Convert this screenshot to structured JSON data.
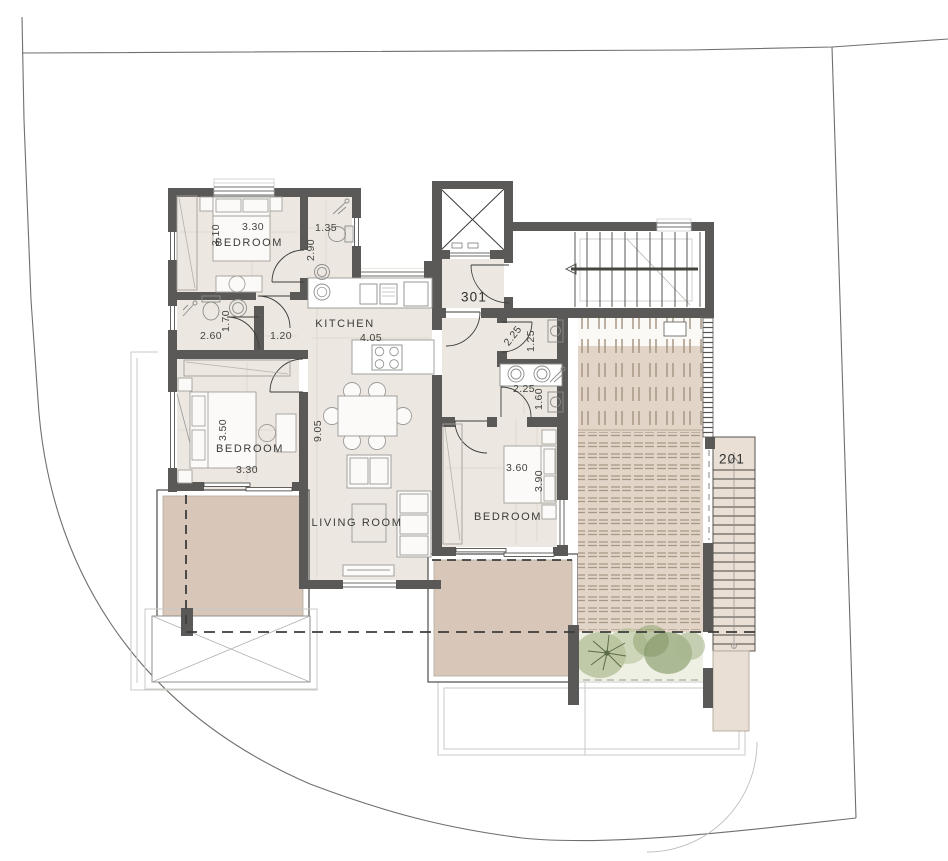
{
  "title": "apartment floor plan",
  "rooms": {
    "bedroom_top": {
      "label": "BEDROOM",
      "width": "3.30",
      "depth": "3.10"
    },
    "bathroom_top": {
      "width": "1.35",
      "depth": "2.90"
    },
    "wc": {
      "width": "2.60",
      "depth": "1.70"
    },
    "hallway": {
      "width": "1.20"
    },
    "kitchen": {
      "label": "KITCHEN",
      "width": "4.05"
    },
    "entrance_hall": {
      "label": "301"
    },
    "utility": {
      "width": "2.25",
      "depth": "1.25"
    },
    "bathroom_right": {
      "width": "2.25",
      "depth": "1.60"
    },
    "bedroom_left": {
      "label": "BEDROOM",
      "width": "3.30",
      "depth": "3.50"
    },
    "living_room": {
      "label": "LIVING ROOM",
      "depth": "9.05"
    },
    "bedroom_right": {
      "label": "BEDROOM",
      "width": "3.60",
      "depth": "3.90"
    },
    "external_stair": {
      "label": "201"
    }
  },
  "colors": {
    "wall": "#5a5958",
    "floor": "#ece7e0",
    "balcony": "#d8c7b9",
    "terrace": "#e2d4c6",
    "greenery": "#8ea06e",
    "line": "#3d3d3b"
  }
}
